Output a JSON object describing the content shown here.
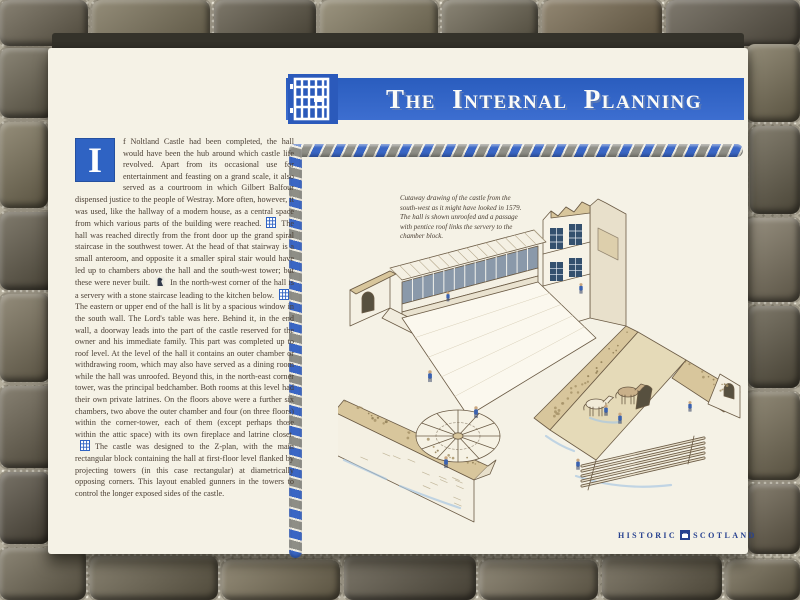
{
  "panel": {
    "title": "The Internal Planning",
    "body": {
      "dropcap": "I",
      "segments": [
        "f Noltland Castle had been completed, the hall would have been the hub around which castle life revolved. Apart from its occasional use for entertainment and feasting on a grand scale, it also served as a courtroom in which Gilbert Balfour dispensed justice to the people of Westray. More often, however, it was used, like the hallway of a modern house, as a central space from which various parts of the building were reached.",
        "The hall was reached directly from the front door up the grand spiral staircase in the southwest tower. At the head of that stairway is a small anteroom, and opposite it a smaller spiral stair would have led up to chambers above the hall and the south-west tower; but these were never built.",
        "In the north-west corner of the hall is a servery with a stone staircase leading to the kitchen below.",
        "The eastern or upper end of the hall is lit by a spacious window in the south wall. The Lord's table was here. Behind it, in the end wall, a doorway leads into the part of the castle reserved for the owner and his immediate family. This part was completed up to roof level. At the level of the hall it contains an outer chamber or withdrawing room, which may also have served as a dining room while the hall was unroofed. Beyond this, in the north-east corner tower, was the principal bedchamber. Both rooms at this level had their own private latrines. On the floors above were a further six chambers, two above the outer chamber and four (on three floors) within the corner-tower, each of them (except perhaps those within the attic space) with its own fireplace and latrine closet.",
        "The castle was designed to the Z-plan, with the main rectangular block containing the hall at first-floor level flanked by projecting towers (in this case rectangular) at diametrically opposing corners. This layout enabled gunners in the towers to control the longer exposed sides of the castle."
      ]
    },
    "caption": "Cutaway drawing of the castle from the south-west as it might have looked in 1579. The hall is shown unroofed and a passage with pentice roof links the servery to the chamber block.",
    "footer": {
      "brand_left": "Historic",
      "brand_right": "Scotland"
    }
  },
  "icons": {
    "banner": "barred-window-yett-icon",
    "inline_1": "plan-grid-icon",
    "inline_2": "figure-icon",
    "inline_3": "plan-grid-icon",
    "inline_4": "plan-grid-icon",
    "brand_emblem": "castle-square-icon"
  },
  "colors": {
    "banner_blue": "#2f63c3",
    "rope_blue": "#3a66c4",
    "rope_grey": "#8e8e86",
    "panel_cream": "#f5f2e6",
    "text_brown": "#4a3e33",
    "brand_blue": "#27418f",
    "illustration_tan": "#d8c69c",
    "figure_blue": "#3a62b0"
  }
}
